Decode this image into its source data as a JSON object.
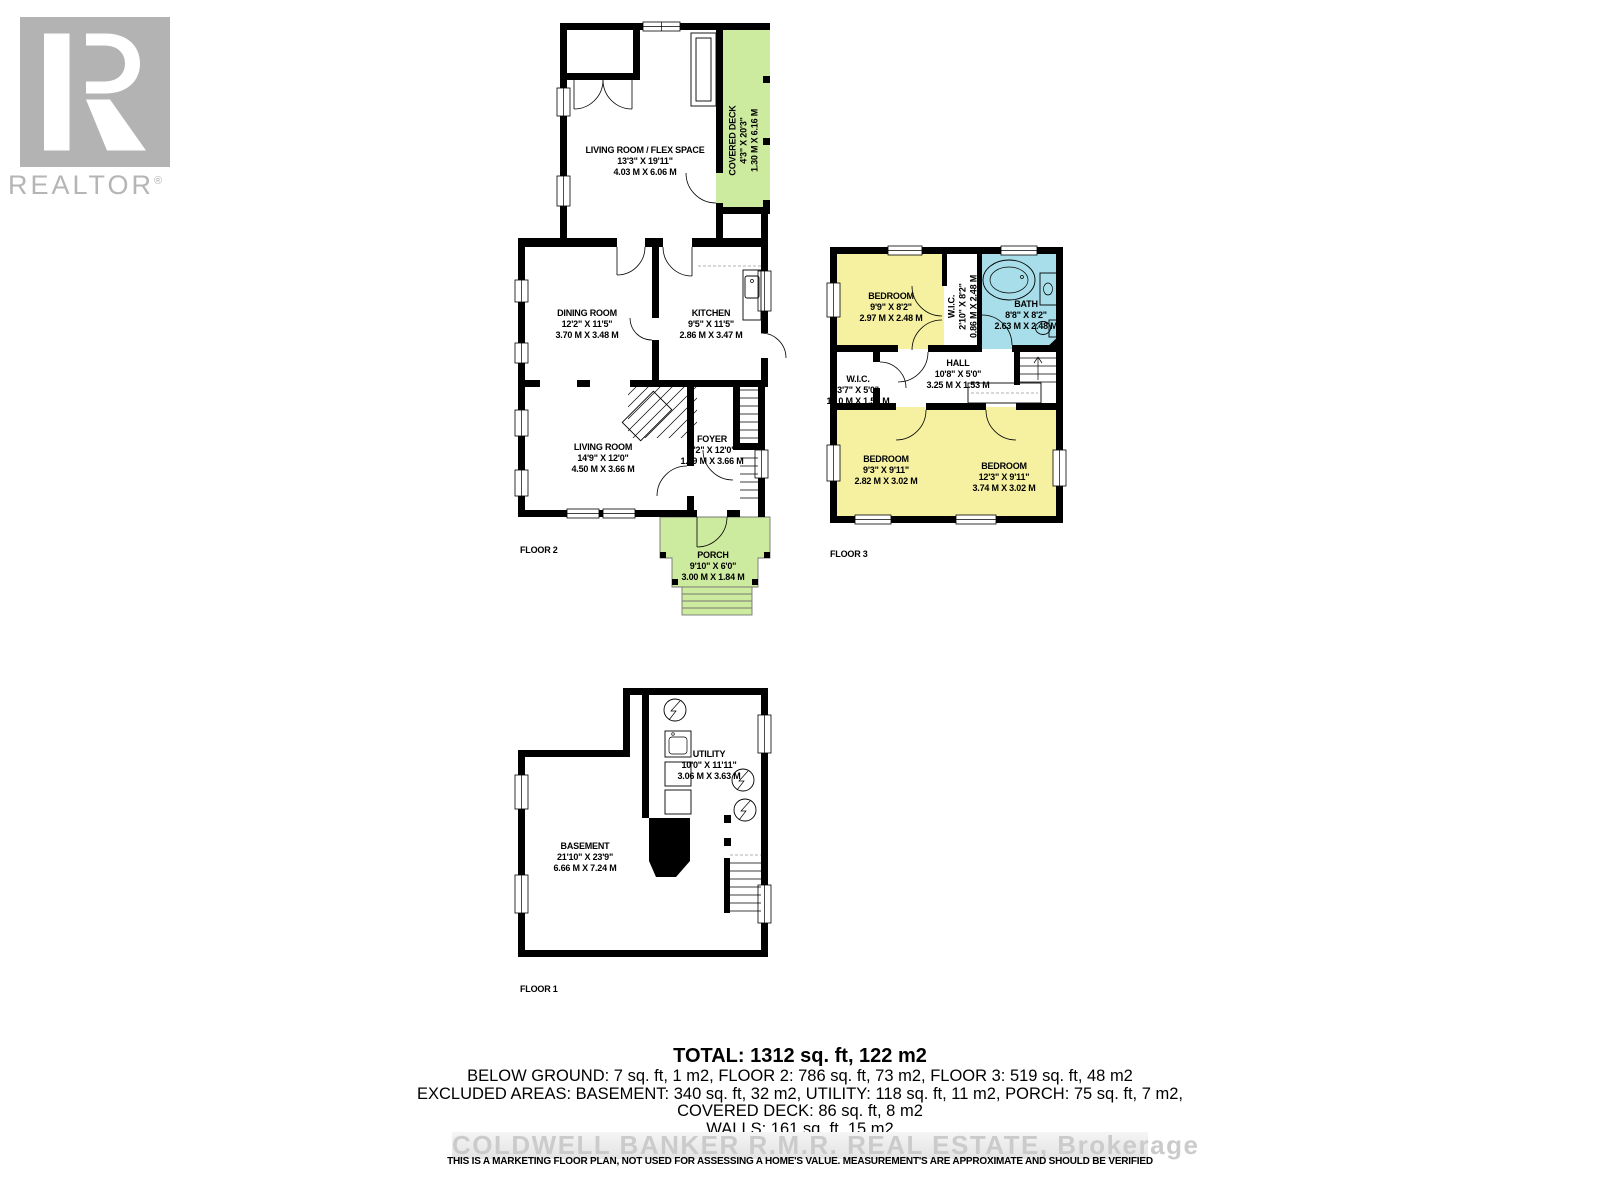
{
  "logo": {
    "letter": "R",
    "brand": "REALTOR",
    "registered": "®"
  },
  "colors": {
    "deck_green": "#cdeb9e",
    "room_yellow": "#f5f1a1",
    "bath_blue": "#a8dee9",
    "wall_black": "#000000",
    "logo_gray": "#b3b3b3",
    "watermark_gray": "#cbcbcb"
  },
  "floors": [
    {
      "label": "FLOOR 2",
      "rooms": [
        {
          "name": "LIVING ROOM / FLEX SPACE",
          "imperial": "13'3\" X 19'11\"",
          "metric": "4.03 M X 6.06 M"
        },
        {
          "name": "COVERED DECK",
          "imperial": "4'3\" X 20'3\"",
          "metric": "1.30 M X 6.16 M"
        },
        {
          "name": "DINING ROOM",
          "imperial": "12'2\" X 11'5\"",
          "metric": "3.70 M X 3.48 M"
        },
        {
          "name": "KITCHEN",
          "imperial": "9'5\" X 11'5\"",
          "metric": "2.86 M X 3.47 M"
        },
        {
          "name": "LIVING ROOM",
          "imperial": "14'9\" X 12'0\"",
          "metric": "4.50 M X 3.66 M"
        },
        {
          "name": "FOYER",
          "imperial": "4'2\" X 12'0\"",
          "metric": "1.29 M X 3.66 M"
        },
        {
          "name": "PORCH",
          "imperial": "9'10\" X 6'0\"",
          "metric": "3.00 M X 1.84 M"
        }
      ]
    },
    {
      "label": "FLOOR 3",
      "rooms": [
        {
          "name": "BEDROOM",
          "imperial": "9'9\" X 8'2\"",
          "metric": "2.97 M X 2.48 M"
        },
        {
          "name": "W.I.C.",
          "imperial": "2'10\" X 8'2\"",
          "metric": "0.86 M X 2.48 M"
        },
        {
          "name": "BATH",
          "imperial": "8'8\" X 8'2\"",
          "metric": "2.63 M X 2.48 M"
        },
        {
          "name": "W.I.C.",
          "imperial": "3'7\" X 5'0\"",
          "metric": "1.10 M X 1.53 M"
        },
        {
          "name": "HALL",
          "imperial": "10'8\" X 5'0\"",
          "metric": "3.25 M X 1.53 M"
        },
        {
          "name": "BEDROOM",
          "imperial": "9'3\" X 9'11\"",
          "metric": "2.82 M X 3.02 M"
        },
        {
          "name": "BEDROOM",
          "imperial": "12'3\" X 9'11\"",
          "metric": "3.74 M X 3.02 M"
        }
      ]
    },
    {
      "label": "FLOOR 1",
      "rooms": [
        {
          "name": "UTILITY",
          "imperial": "10'0\" X 11'11\"",
          "metric": "3.06 M X 3.63 M"
        },
        {
          "name": "BASEMENT",
          "imperial": "21'10\" X 23'9\"",
          "metric": "6.66 M X 7.24 M"
        }
      ]
    }
  ],
  "summary": {
    "total": "TOTAL: 1312 sq. ft, 122 m2",
    "line2": "BELOW GROUND: 7 sq. ft, 1 m2, FLOOR 2: 786 sq. ft, 73 m2, FLOOR 3: 519 sq. ft, 48 m2",
    "line3": "EXCLUDED AREAS: BASEMENT: 340 sq. ft, 32 m2, UTILITY: 118 sq. ft, 11 m2, PORCH: 75 sq. ft, 7 m2,",
    "line4": "COVERED DECK: 86 sq. ft, 8 m2",
    "line5": "WALLS: 161 sq. ft, 15 m2"
  },
  "watermark": "COLDWELL BANKER  R.M.R. REAL ESTATE, Brokerage",
  "disclaimer": "THIS IS A MARKETING FLOOR PLAN, NOT USED FOR ASSESSING A HOME'S VALUE. MEASUREMENT'S ARE APPROXIMATE AND SHOULD BE VERIFIED"
}
